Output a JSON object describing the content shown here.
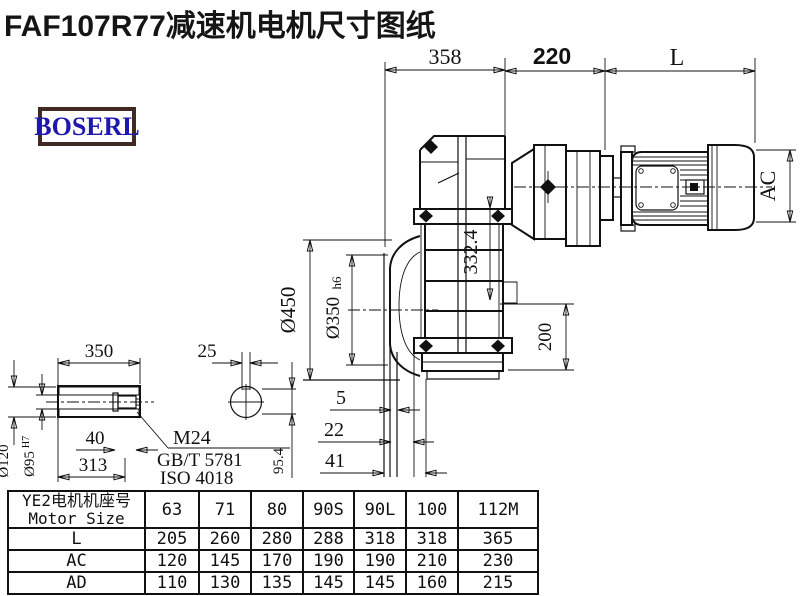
{
  "title": "FAF107R77减速机电机尺寸图纸",
  "logo": {
    "text": "BOSERL",
    "border_color": "#402a22",
    "text_color": "#1e18b0"
  },
  "colors": {
    "line": "#111111",
    "background": "#ffffff"
  },
  "drawing": {
    "dims": {
      "gearbox_length": "358",
      "adapter_length": "220",
      "motor_length": "L",
      "flange_diameter": "Ø450",
      "spigot_diameter": "Ø350",
      "spigot_tolerance": "h6",
      "center_height": "332.4",
      "base_height": "200",
      "motor_diameter": "AC",
      "flange_offset_1": "5",
      "flange_offset_2": "22",
      "flange_offset_3": "41"
    },
    "shaft": {
      "length": "350",
      "key_width": "25",
      "bolt_engagement": "40",
      "inner_length": "313",
      "outer_diameter": "Ø120",
      "bore_diameter": "Ø95",
      "bore_tolerance": "H7",
      "key_height": "95.4",
      "bolt_label": "M24",
      "standard_1": "GB/T 5781",
      "standard_2": "ISO 4018"
    }
  },
  "table": {
    "header_cn": "YE2电机机座号",
    "header_en": "Motor Size",
    "columns": [
      "63",
      "71",
      "80",
      "90S",
      "90L",
      "100",
      "112M"
    ],
    "rows": [
      {
        "label": "L",
        "values": [
          "205",
          "260",
          "280",
          "288",
          "318",
          "318",
          "365"
        ]
      },
      {
        "label": "AC",
        "values": [
          "120",
          "145",
          "170",
          "190",
          "190",
          "210",
          "230"
        ]
      },
      {
        "label": "AD",
        "values": [
          "110",
          "130",
          "135",
          "145",
          "145",
          "160",
          "215"
        ]
      }
    ]
  }
}
